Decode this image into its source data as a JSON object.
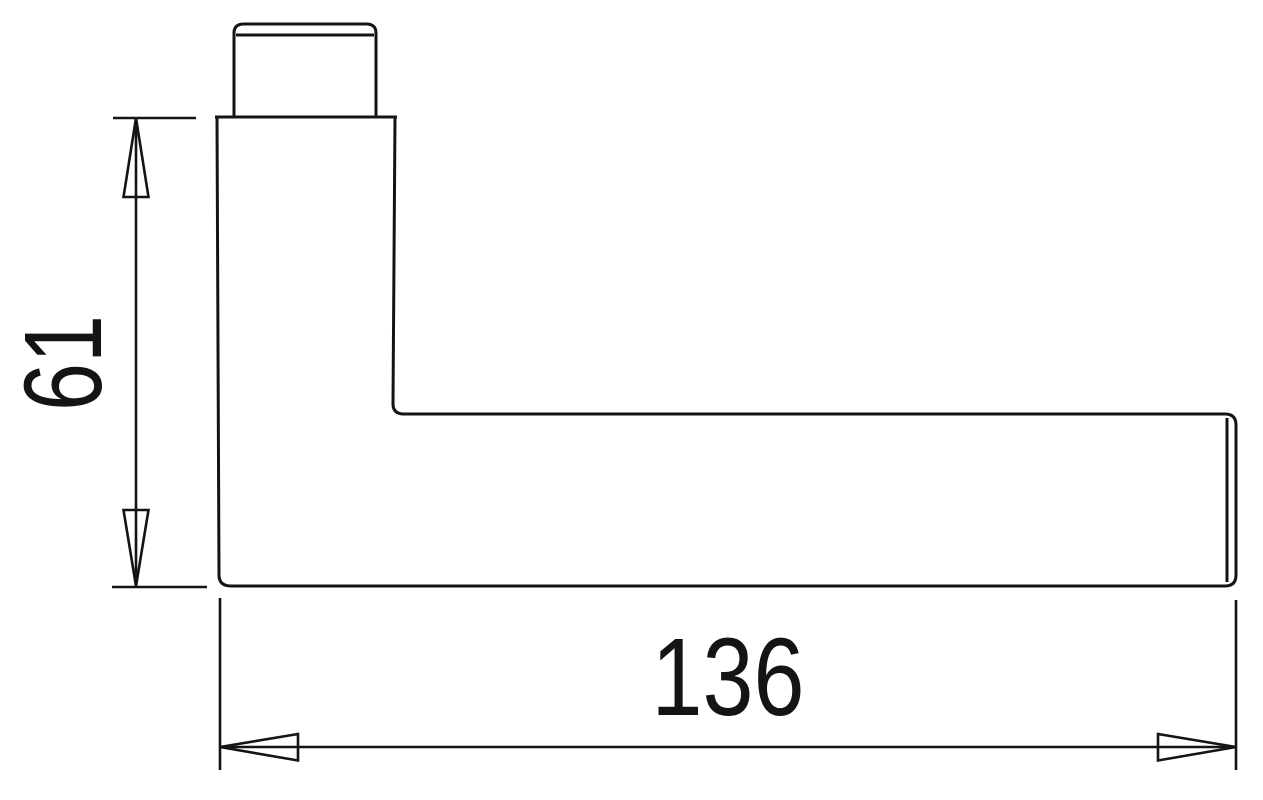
{
  "drawing": {
    "line_color": "#141414",
    "background_color": "#ffffff",
    "dimensions": {
      "vertical": {
        "value": "61",
        "orientation": "vertical"
      },
      "horizontal": {
        "value": "136",
        "orientation": "horizontal"
      }
    }
  }
}
